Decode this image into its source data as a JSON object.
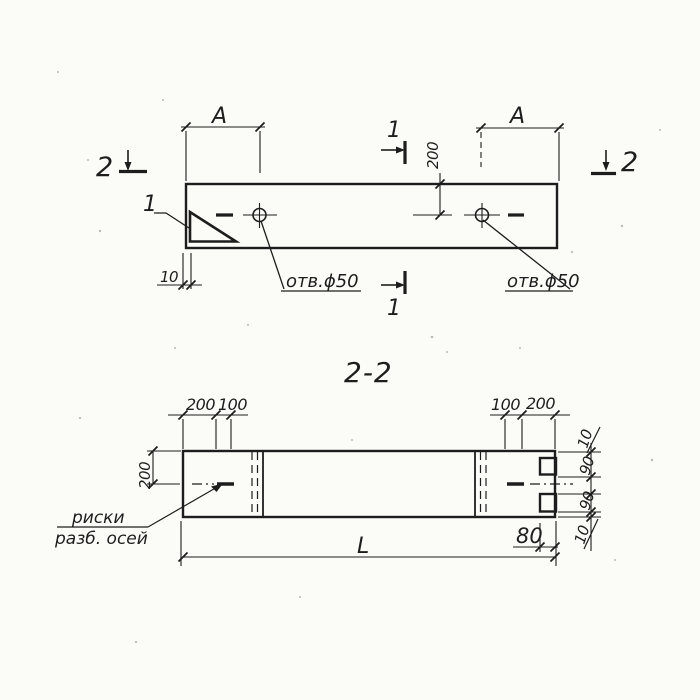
{
  "plan": {
    "marker2_left": "2",
    "marker2_right": "2",
    "marker1_top": "1",
    "marker1_bottom": "1",
    "corner_detail_label": "1",
    "dimA_left": "A",
    "dimA_right": "A",
    "dim200": "200",
    "dim10": "10",
    "hole_left_label": "отв.ϕ50",
    "hole_right_label": "отв.ϕ50"
  },
  "section": {
    "title": "2-2",
    "top_left_200": "200",
    "top_left_100": "100",
    "top_right_100": "100",
    "top_right_200": "200",
    "left_200": "200",
    "right_10_top": "10",
    "right_90_top": "90",
    "right_90_bottom": "90",
    "right_10_bottom": "10",
    "dim80": "80",
    "dimL": "L",
    "axis_note_line1": "риски",
    "axis_note_line2": "разб. осей"
  },
  "colors": {
    "ink": "#1d1d1d",
    "paper": "#fbfbf8"
  }
}
